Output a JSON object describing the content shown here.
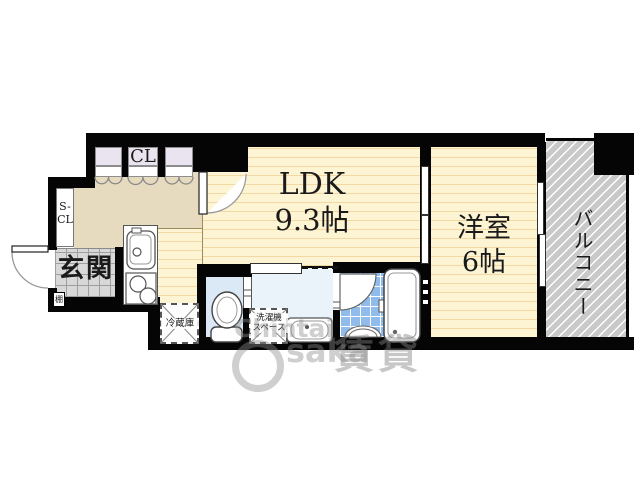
{
  "rooms": {
    "ldk": {
      "label": "LDK",
      "size": "9.3帖"
    },
    "bedroom": {
      "label": "洋室",
      "size": "6帖"
    },
    "balcony": {
      "label": "バルコニー"
    },
    "entrance": {
      "label": "玄関"
    },
    "closet": {
      "label": "CL"
    },
    "shoe_closet": {
      "line1": "S-",
      "line2": "CL"
    },
    "shelf": {
      "label": "棚"
    }
  },
  "fixtures": {
    "refrigerator": {
      "label": "冷蔵庫"
    },
    "washer": {
      "line1": "洗濯機",
      "line2": "スペース"
    }
  },
  "watermark": {
    "word1": "Chintai",
    "word2": "saka",
    "kanji": "賃貸"
  },
  "colors": {
    "wall": "#050505",
    "floor_yellow": "#FDF4D4",
    "floor_stripe": "#F3D8A4",
    "hallway_beige": "#E7DBBF",
    "closet_lavender": "#E9E4EF",
    "genkan_tile": "#D8D8D8",
    "toilet_room": "#DBE9F6",
    "washroom": "#EBF3FA",
    "bath_tile": "#8FBCEA",
    "balcony_gray": "#C9C9C9"
  }
}
